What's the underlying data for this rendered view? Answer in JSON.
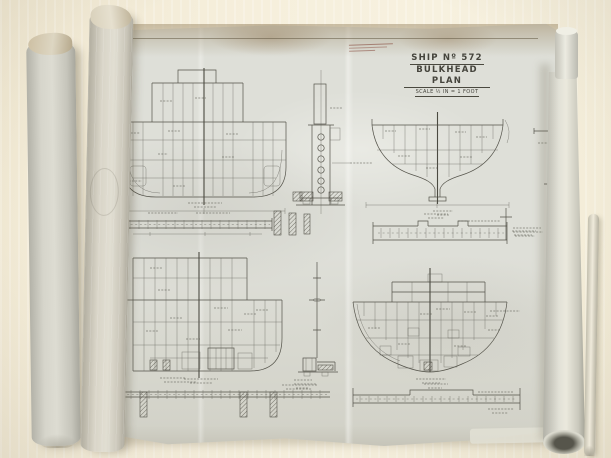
{
  "scene": {
    "subject": "Photograph of an unrolled vintage ship blueprint on a table with rolled drawings at its sides"
  },
  "title_block": {
    "ship_no": "SHIP Nº 572",
    "plan_name": "BULKHEAD PLAN",
    "scale": "SCALE ½ IN = 1 FOOT"
  },
  "stamp": {
    "legible": false
  },
  "colors": {
    "table": "#f3ecd8",
    "sheet_paper": "#d6d7cf",
    "roll_paper": "#d6d5cb",
    "ink": "#54534a",
    "top_edge_stain": "#a89272",
    "stamp_ink": "#7d3e32"
  },
  "views": [
    {
      "name": "bulkhead-section-upper-left",
      "caption_legible": false
    },
    {
      "name": "pillar-detail-center",
      "caption_legible": false
    },
    {
      "name": "bow-bulkhead-section-upper-right",
      "caption_legible": false
    },
    {
      "name": "plan-strip-mid-left",
      "caption_legible": false
    },
    {
      "name": "plan-strip-mid-right",
      "caption_legible": false
    },
    {
      "name": "bulkhead-section-lower-left",
      "caption_legible": false
    },
    {
      "name": "bulkhead-section-lower-right",
      "caption_legible": false
    },
    {
      "name": "stiffener-strip-bottom-left",
      "caption_legible": false
    },
    {
      "name": "stiffener-strip-bottom-right",
      "caption_legible": false
    },
    {
      "name": "bracket-details-right-margin",
      "caption_legible": false
    }
  ]
}
